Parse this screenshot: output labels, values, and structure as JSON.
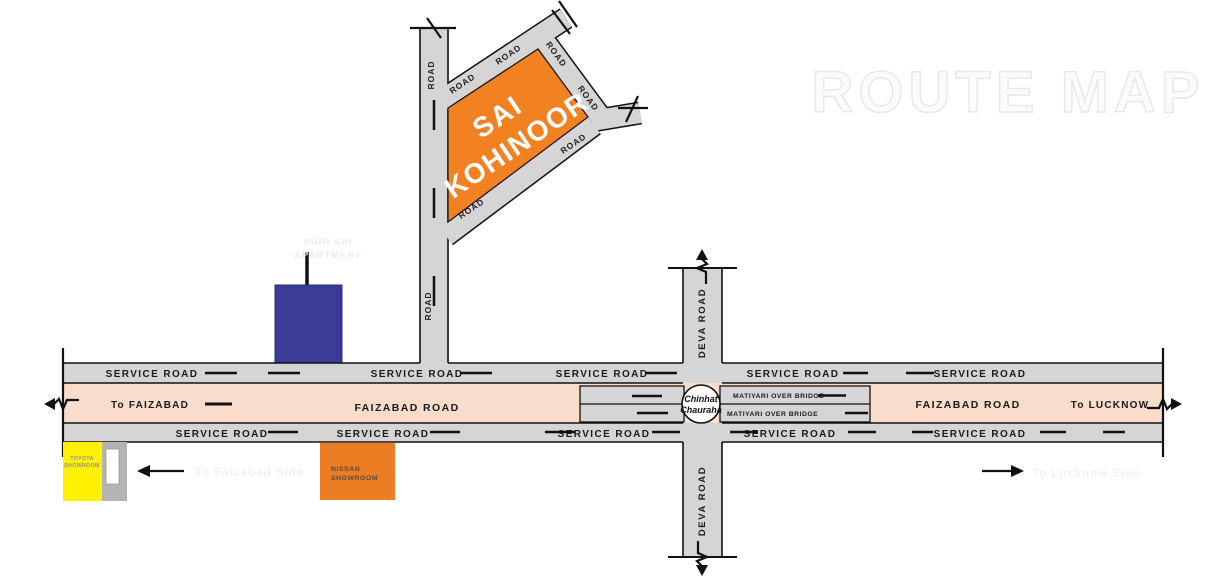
{
  "watermark": "ROUTE MAP",
  "plot": {
    "line1": "SAI",
    "line2": "KOHINOOR"
  },
  "labels": {
    "road": "ROAD",
    "service_road": "SERVICE ROAD",
    "faizabad_road": "FAIZABAD ROAD",
    "deva_road": "DEVA ROAD",
    "to_faizabad": "To FAIZABAD",
    "to_lucknow": "To LUCKNOW",
    "matiyari_over_bridge": "MATIYARI OVER BRIDGE",
    "chinhat_line1": "Chinhat",
    "chinhat_line2": "Chauraha"
  },
  "landmarks": {
    "toyota_line1": "TOYOTA",
    "toyota_line2": "SHOWROOM",
    "nissan_line1": "NISSAN",
    "nissan_line2": "SHOWROOM",
    "faint_building_line1": "SHRI SAI",
    "faint_building_line2": "APARTMENT",
    "faint_left": "To Faizabad Side",
    "faint_right": "To Lucknow Side"
  },
  "colors": {
    "road_gray": "#d5d5d5",
    "faizabad_pink": "#fadccb",
    "plot_orange": "#F28121",
    "nissan_orange": "#EC7D23",
    "toyota_yellow": "#FFF000",
    "building_blue": "#3B3A95",
    "line_black": "#111111"
  }
}
